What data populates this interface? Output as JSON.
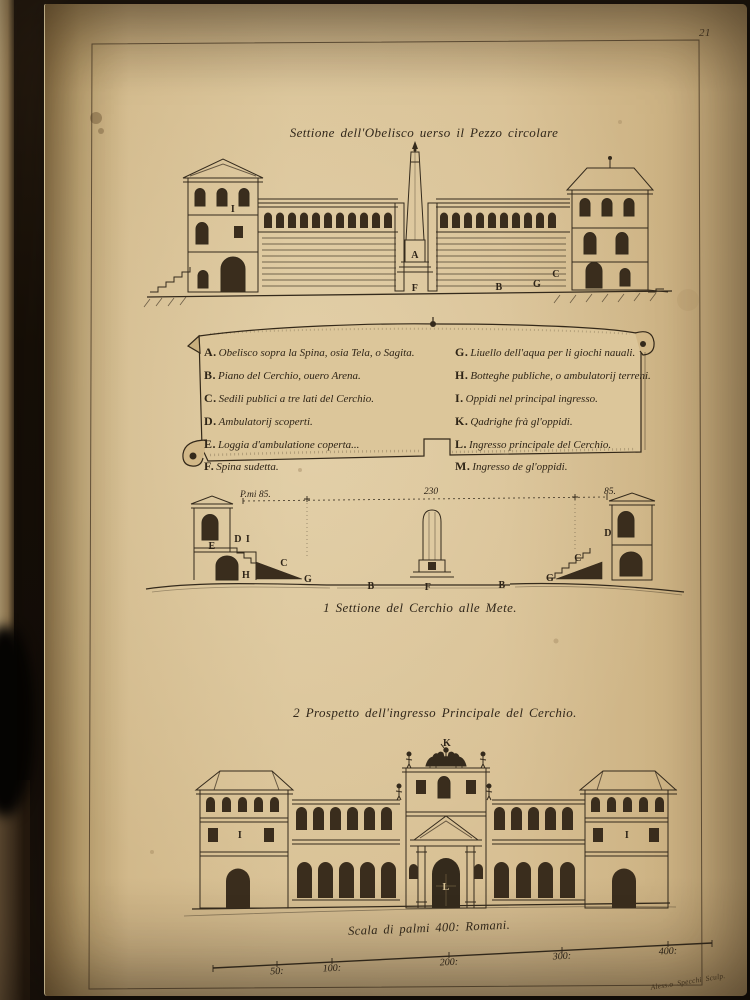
{
  "page_number": "21",
  "title": "Settione dell'Obelisco uerso il Pezzo circolare",
  "captions": {
    "section": "1 Settione del Cerchio alle Mete.",
    "prospetto": "2 Prospetto dell'ingresso Principale del Cerchio."
  },
  "legend": {
    "left": [
      {
        "k": "A.",
        "t": "Obelisco sopra la Spina, osia Tela, o Sagita."
      },
      {
        "k": "B.",
        "t": "Piano del Cerchio, ouero Arena."
      },
      {
        "k": "C.",
        "t": "Sedili publici a tre lati del Cerchio."
      },
      {
        "k": "D.",
        "t": "Ambulatorij scoperti."
      },
      {
        "k": "E.",
        "t": "Loggia d'ambulatione coperta..."
      },
      {
        "k": "F.",
        "t": "Spina sudetta."
      }
    ],
    "right": [
      {
        "k": "G.",
        "t": "Liuello dell'aqua per li giochi nauali."
      },
      {
        "k": "H.",
        "t": "Botteghe publiche, o ambulatorij terreni."
      },
      {
        "k": "I.",
        "t": "Oppidi nel principal ingresso."
      },
      {
        "k": "K.",
        "t": "Qadrighe frà gl'oppidi."
      },
      {
        "k": "L.",
        "t": "Ingresso principale del Cerchio."
      },
      {
        "k": "M.",
        "t": "Ingresso de gl'oppidi."
      }
    ]
  },
  "dimensions": {
    "left": "P.mi 85.",
    "center": "230",
    "right": "85."
  },
  "scale": {
    "label": "Scala di palmi 400: Romani.",
    "ticks": [
      "50:",
      "100:",
      "200:",
      "300:",
      "400:"
    ]
  },
  "signature": "Aless.o Specchi Sculp.",
  "figure_labels": {
    "top": {
      "tower_i": "I",
      "obelisk_a": "A",
      "spina_f": "F",
      "arena_b": "B",
      "ground_g": "G",
      "seats_c": "C"
    },
    "middle": {
      "loggia_e": "E",
      "amb_d_l": "D",
      "oppidi_i": "I",
      "seats_c_l": "C",
      "shops_h": "H",
      "level_g_l": "G",
      "arena_b_l": "B",
      "spina_f": "F",
      "arena_b_r": "B",
      "level_g_r": "G",
      "seats_c_r": "C",
      "amb_d_r": "D"
    },
    "bottom": {
      "quadriga_k": "K",
      "portal_l": "L",
      "pavilion_i_l": "I",
      "pavilion_i_r": "I"
    }
  },
  "colors": {
    "paper": "#d8c094",
    "ink": "#2e2418"
  }
}
